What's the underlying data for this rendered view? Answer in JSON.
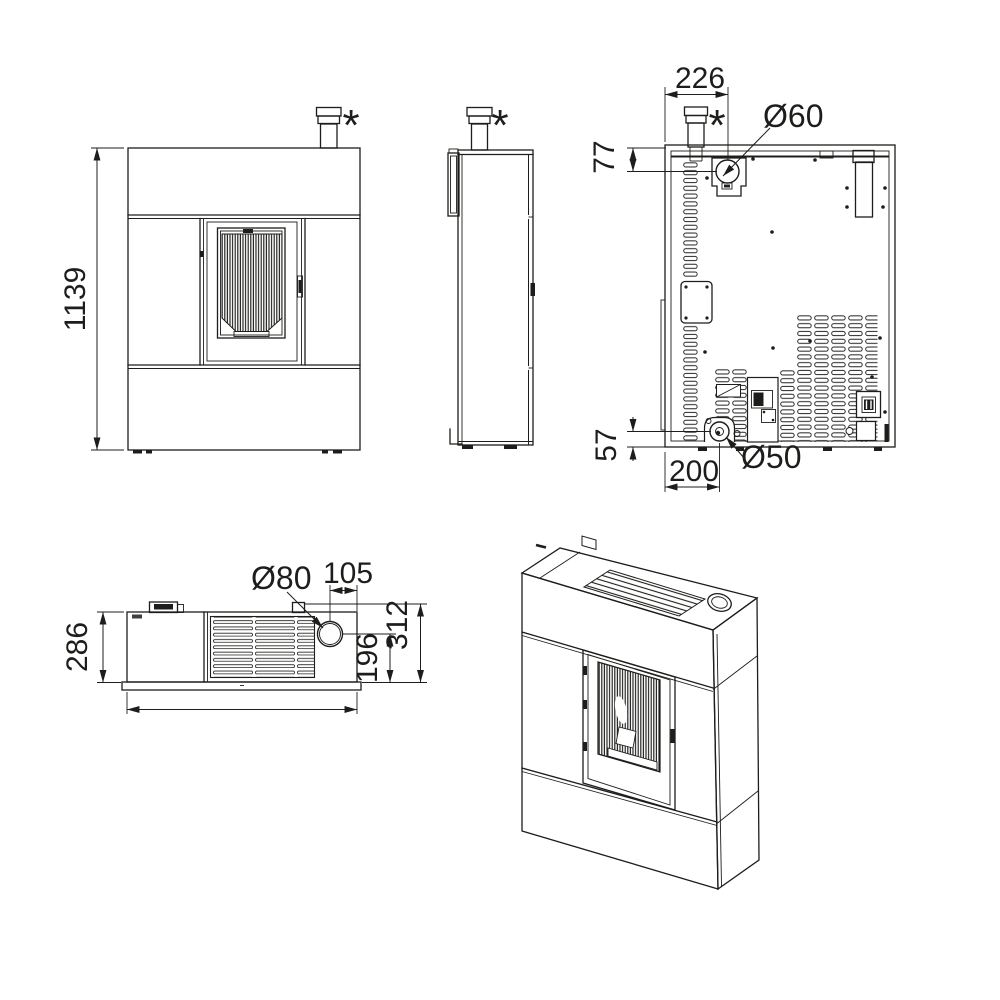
{
  "document": {
    "type": "technical-drawing",
    "subject": "pellet stove dimensional drawing, five views: front, side, rear, top, isometric"
  },
  "colors": {
    "line": "#1d1d1b",
    "background": "#ffffff"
  },
  "dimensions": {
    "front_height": "1139",
    "rear_flue_offset_x": "226",
    "rear_intake_offset_y": "77",
    "rear_intake_diameter": "Ø60",
    "rear_exhaust_height": "57",
    "rear_exhaust_diameter": "Ø50",
    "rear_exhaust_offset_x": "200",
    "top_depth": "286",
    "top_flue_diameter": "Ø80",
    "top_flue_offset_right": "105",
    "top_flue_offset_front": "196",
    "top_overall_depth": "312",
    "flue_marker_front": "*",
    "flue_marker_side": "*",
    "flue_marker_rear": "*"
  }
}
